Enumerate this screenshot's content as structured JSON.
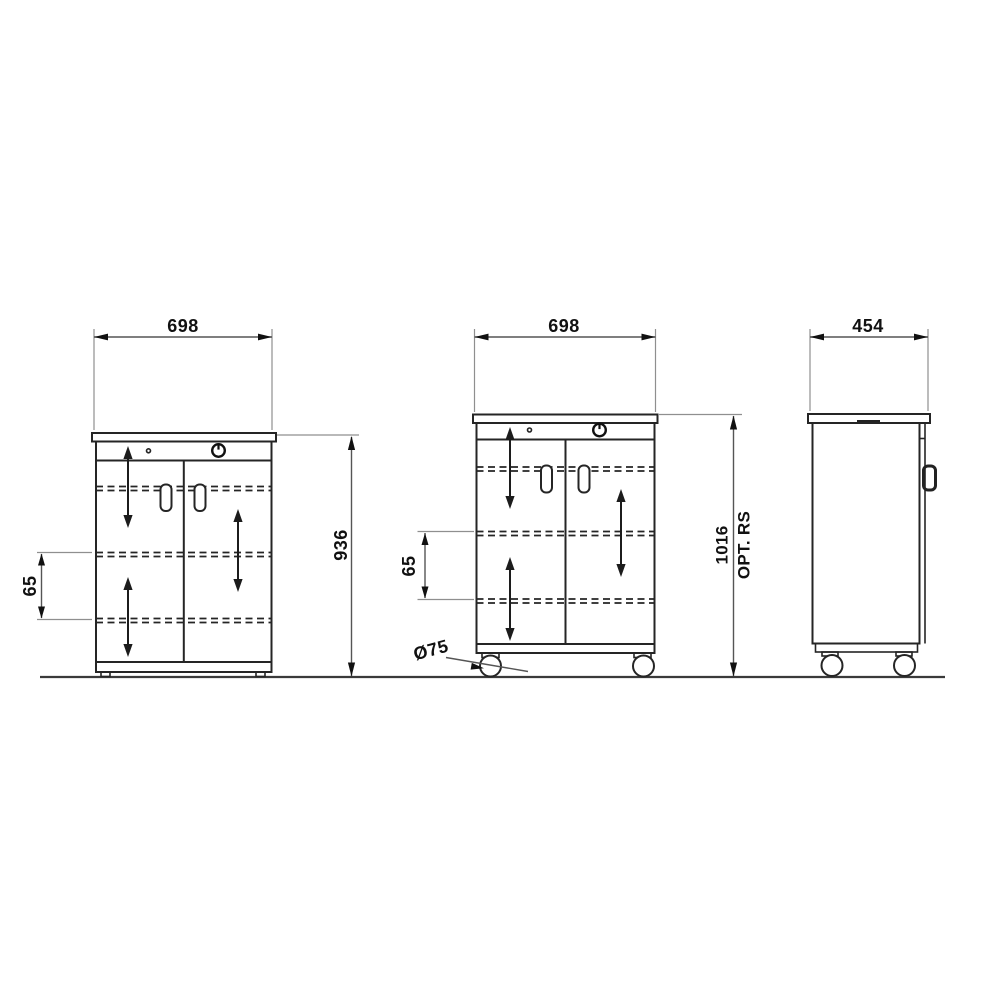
{
  "drawing": {
    "type": "technical-dimension-drawing",
    "subject": "mobile two-door cabinet, three orthographic views",
    "colors": {
      "background": "#ffffff",
      "line": "#252525",
      "dimension_line": "#555555",
      "text": "#111111"
    },
    "front_view": {
      "width_label": "698",
      "height_label": "936",
      "shelf_gap_label": "65"
    },
    "middle_view": {
      "width_label": "698",
      "height_label": "1016",
      "height_note": "OPT. RS",
      "shelf_gap_label": "65",
      "caster_diameter_label": "Ø75"
    },
    "side_view": {
      "depth_label": "454"
    }
  }
}
